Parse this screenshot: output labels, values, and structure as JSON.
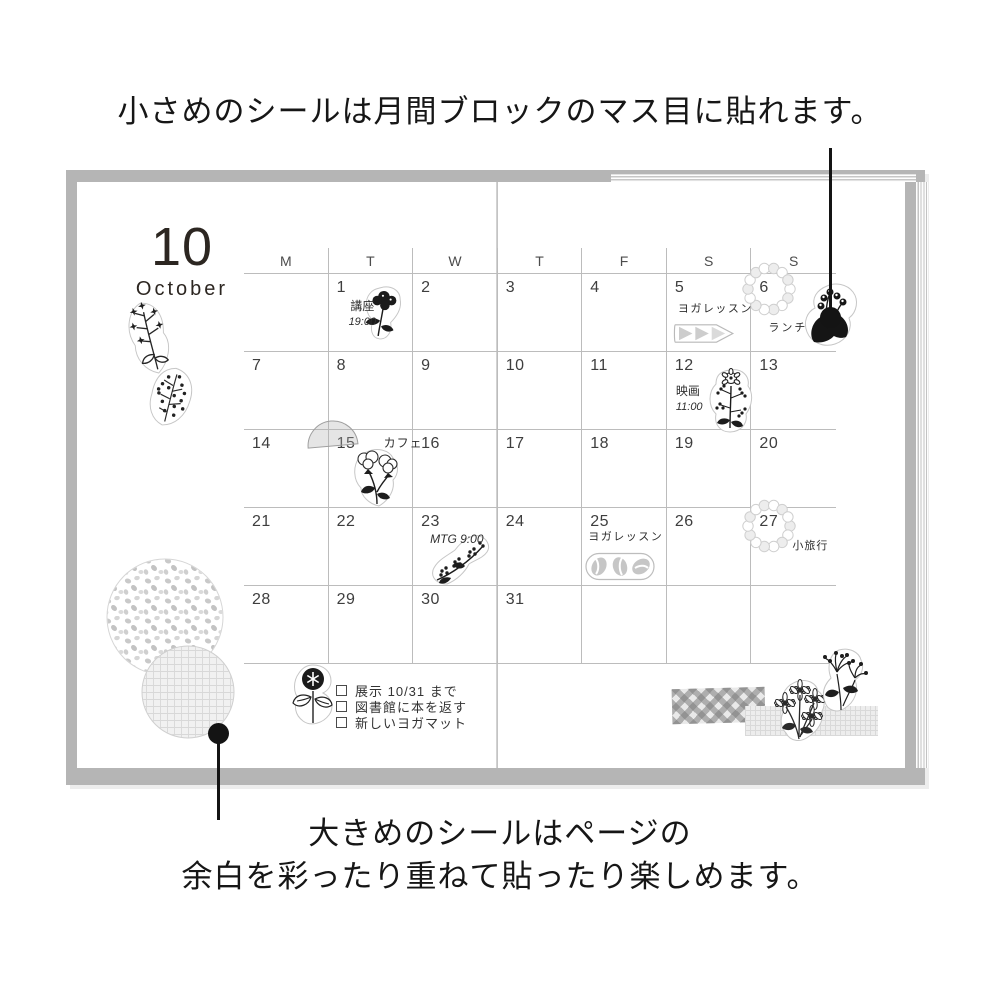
{
  "captions": {
    "top": "小さめのシールは月間ブロックのマス目に貼れます。",
    "bottom_line1": "大きめのシールはページの",
    "bottom_line2": "余白を彩ったり重ねて貼ったり楽しめます。"
  },
  "calendar": {
    "month_number": "10",
    "month_name": "October",
    "weekday_headers": [
      "M",
      "T",
      "W",
      "T",
      "F",
      "S",
      "S"
    ],
    "days": [
      {
        "date": ""
      },
      {
        "date": "1",
        "label": "講座",
        "time": "19:00"
      },
      {
        "date": "2"
      },
      {
        "date": "3"
      },
      {
        "date": "4"
      },
      {
        "date": "5",
        "label": "ヨガレッスン"
      },
      {
        "date": "6",
        "label": "ランチ"
      },
      {
        "date": "7"
      },
      {
        "date": "8"
      },
      {
        "date": "9"
      },
      {
        "date": "10"
      },
      {
        "date": "11"
      },
      {
        "date": "12",
        "label": "映画",
        "time": "11:00"
      },
      {
        "date": "13"
      },
      {
        "date": "14"
      },
      {
        "date": "15",
        "label": "カフェ"
      },
      {
        "date": "16"
      },
      {
        "date": "17"
      },
      {
        "date": "18"
      },
      {
        "date": "19"
      },
      {
        "date": "20"
      },
      {
        "date": "21"
      },
      {
        "date": "22"
      },
      {
        "date": "23",
        "label": "MTG 9:00"
      },
      {
        "date": "24"
      },
      {
        "date": "25",
        "label": "ヨガレッスン"
      },
      {
        "date": "26"
      },
      {
        "date": "27",
        "label": "小旅行"
      },
      {
        "date": "28"
      },
      {
        "date": "29"
      },
      {
        "date": "30"
      },
      {
        "date": "31"
      },
      {
        "date": ""
      },
      {
        "date": ""
      },
      {
        "date": ""
      }
    ]
  },
  "checklist": {
    "items": [
      "展示 10/31 まで",
      "図書館に本を返す",
      "新しいヨガマット"
    ]
  },
  "stickers": [
    "star-branch-sticker",
    "berry-leaf-sticker",
    "flower-day1-sticker",
    "triangle-arrows-sticker",
    "scallop-wreath-day6-sticker",
    "lily-of-the-valley-sticker",
    "flower-day12-sticker",
    "half-circle-day15-sticker",
    "cotton-flower-sticker",
    "flower-day23-sticker",
    "coffee-beans-sticker",
    "scallop-wreath-day27-sticker",
    "dotted-circle-sticker",
    "mesh-circle-sticker",
    "checklist-flower-sticker",
    "gingham-tape-sticker",
    "mesh-tape-sticker",
    "daisy-bouquet-sticker",
    "pompon-flower-sticker"
  ],
  "colors": {
    "cover_gray": "#b5b5b5",
    "grid_line": "#bcbcbc",
    "ink": "#1a1a1a",
    "sticker_gray": "#c9c9c9"
  }
}
